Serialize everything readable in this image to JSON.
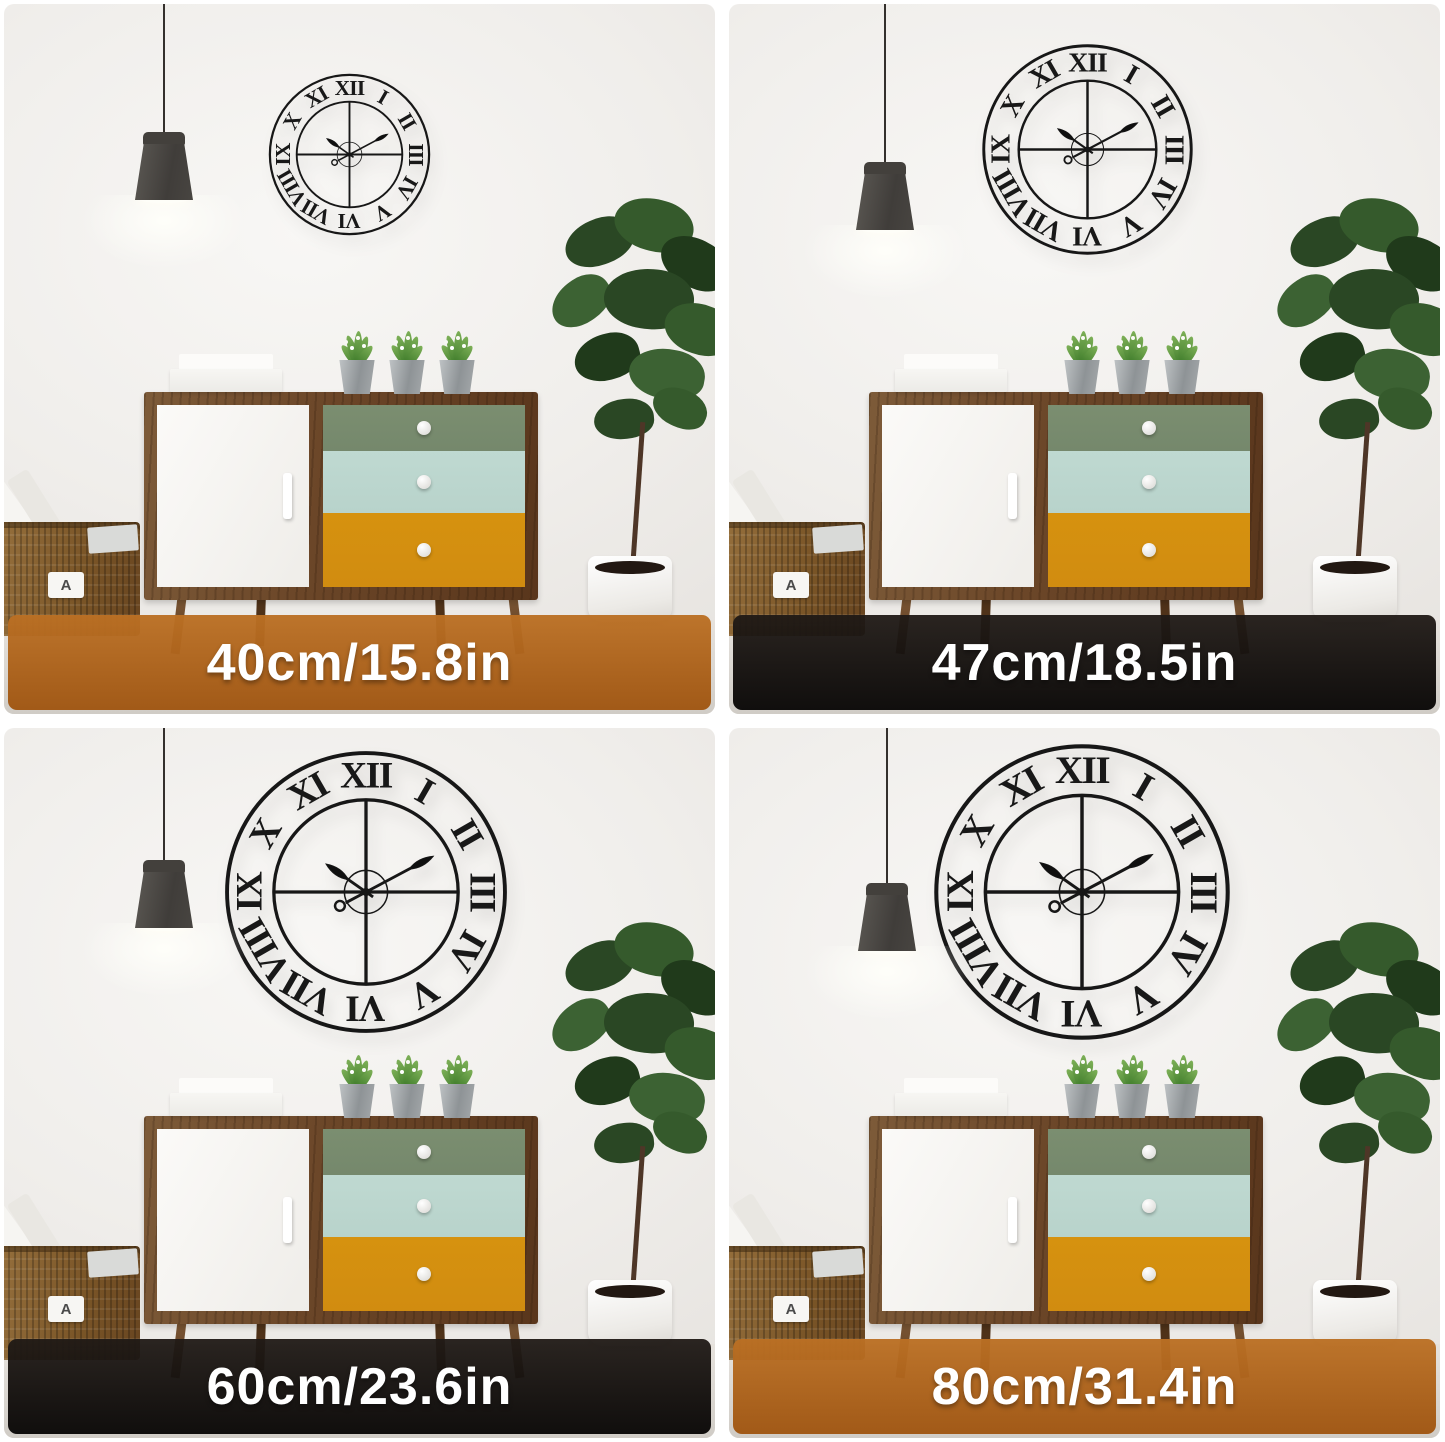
{
  "panels": [
    {
      "size_label": "40cm/15.8in",
      "banner_theme": "orange"
    },
    {
      "size_label": "47cm/18.5in",
      "banner_theme": "dark"
    },
    {
      "size_label": "60cm/23.6in",
      "banner_theme": "dark"
    },
    {
      "size_label": "80cm/31.4in",
      "banner_theme": "orange"
    }
  ],
  "clock": {
    "numerals": [
      "XII",
      "I",
      "II",
      "III",
      "IV",
      "V",
      "VI",
      "VII",
      "VIII",
      "IX",
      "X",
      "XI"
    ],
    "time_displayed": "10:10",
    "hour_angle_deg": 305,
    "minute_angle_deg": 62,
    "metal_color": "#171717",
    "pin_color": "#b5872e"
  },
  "basket": {
    "label": "A"
  },
  "colors": {
    "banner_orange": "#b06120",
    "banner_dark": "#14100e",
    "banner_text": "#ffffff",
    "drawer_top_green": "#75886c",
    "drawer_middle_mint": "#b8d3cb",
    "drawer_bottom_orange": "#d18c10",
    "cabinet_wood": "#6b4729"
  }
}
